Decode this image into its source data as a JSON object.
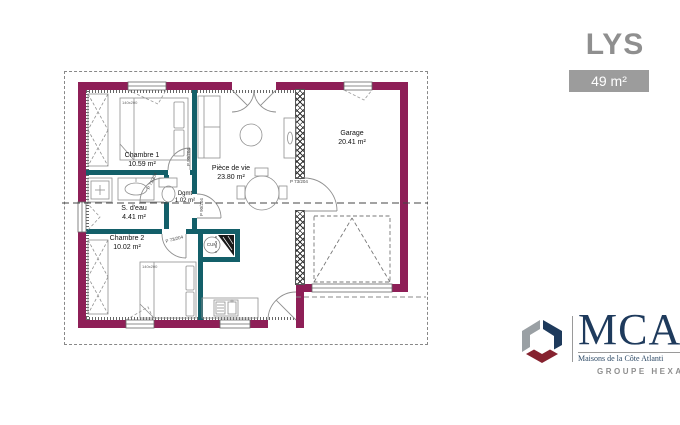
{
  "header": {
    "title": "LYS",
    "area_badge": "49 m²"
  },
  "plan": {
    "rooms": [
      {
        "name": "Chambre 1",
        "area": "10.59 m²"
      },
      {
        "name": "S. d'eau",
        "area": "4.41 m²"
      },
      {
        "name": "Chambre 2",
        "area": "10.02 m²"
      },
      {
        "name": "Dgmt",
        "area": "1.02 m²"
      },
      {
        "name": "Pièce de vie",
        "area": "23.80 m²"
      },
      {
        "name": "Garage",
        "area": "20.41 m²"
      }
    ],
    "labels": {
      "bed1": "140x200",
      "bed2": "140x200",
      "water_heater": "CUM"
    },
    "doors": {
      "bathroom": "P 73/204",
      "bedroom1": "P 90/204",
      "bedroom2": "P 73/204",
      "living": "P 90/204",
      "garage": "P 73/204"
    },
    "colors": {
      "exterior_wall": "#8e1f57",
      "interior_wall": "#135f69"
    }
  },
  "brand": {
    "monogram": "MCA",
    "tagline": "Maisons de la Côte Atlanti",
    "group_label": "GROUPE HEXA",
    "colors": {
      "navy": "#1e3a5c",
      "maroon": "#86222f",
      "gray": "#9aa0a4"
    }
  }
}
